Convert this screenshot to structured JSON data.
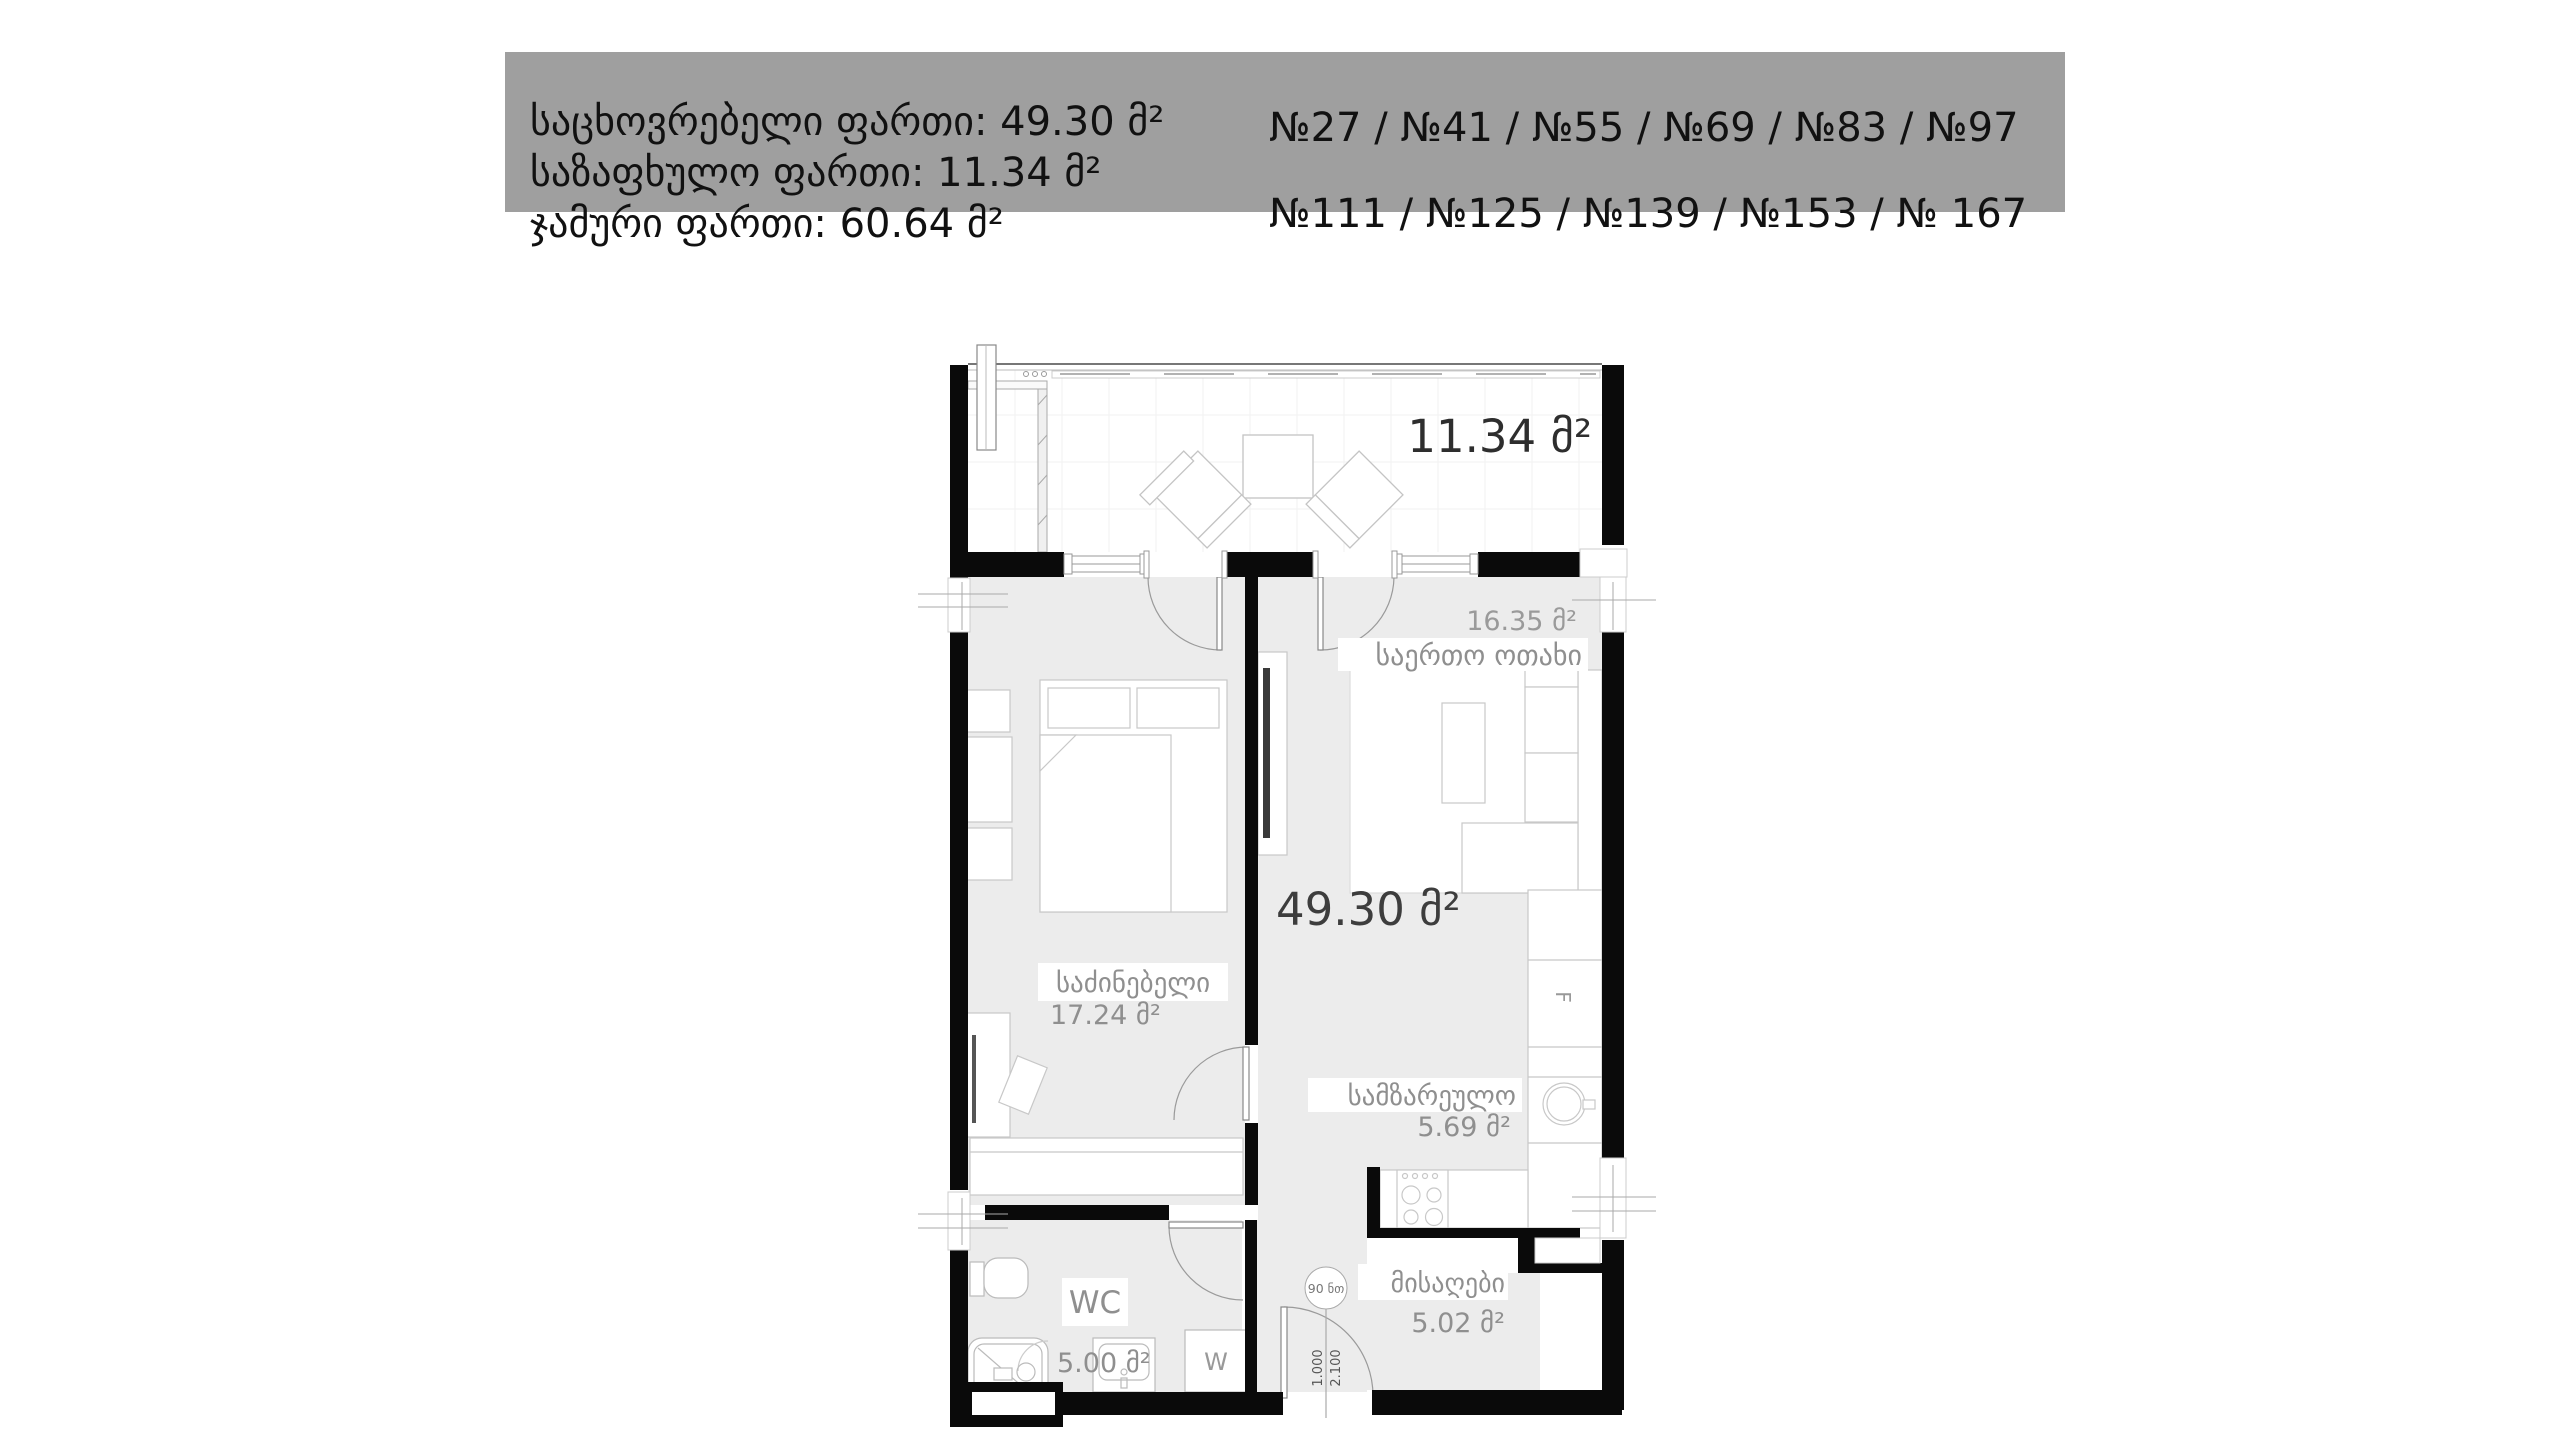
{
  "header": {
    "area_lines": [
      "საცხოვრებელი ფართი: 49.30 მ²",
      "საზაფხულო ფართი: 11.34 მ²",
      "ჯამური ფართი: 60.64 მ²"
    ],
    "unit_lines": [
      "№27 / №41 / №55 / №69 / №83 / №97",
      "№111 / №125 / №139 / №153 / № 167"
    ]
  },
  "plan": {
    "apartment_total": {
      "area": "49.30 მ²"
    },
    "balcony": {
      "area": "11.34 მ²"
    },
    "living_room": {
      "name": "საერთო ოთახი",
      "area": "16.35 მ²"
    },
    "bedroom": {
      "name": "საძინებელი",
      "area": "17.24 მ²"
    },
    "kitchen": {
      "name": "სამზარეულო",
      "area": "5.69 მ²"
    },
    "wc": {
      "name": "WC",
      "area": "5.00 მ²"
    },
    "hall": {
      "name": "მისაღები",
      "area": "5.02 მ²"
    },
    "annotations": {
      "entry_door_size": "90 ნთ",
      "entry_door_width": "1.000",
      "entry_door_height": "2.100",
      "washer": "W",
      "fridge": "F"
    }
  },
  "colors": {
    "header_bg": "#9f9f9f",
    "header_text": "#111111",
    "wall": "#0a0a0a",
    "floor": "#ececec",
    "label_gray": "#8f8f8f",
    "area_gray": "#9a9a9a",
    "big_label": "#3d3d3d"
  }
}
